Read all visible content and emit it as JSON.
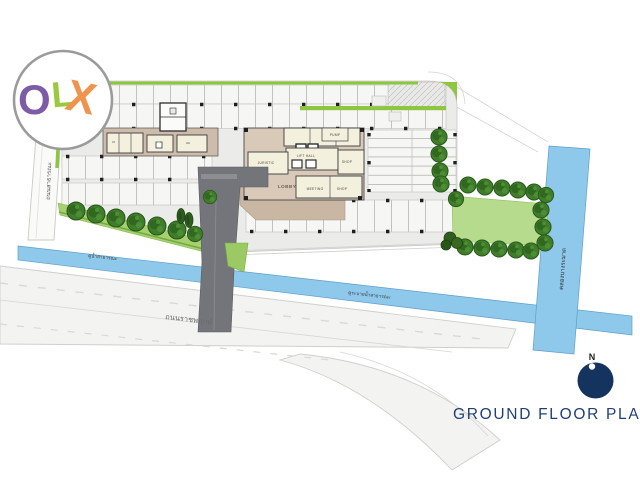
{
  "logo": {
    "letters": [
      {
        "char": "O",
        "color": "#7d5ba6"
      },
      {
        "char": "L",
        "color": "#9bc93d"
      },
      {
        "char": "X",
        "color": "#f0944d"
      }
    ]
  },
  "title": {
    "text": "GROUND FLOOR PLAN"
  },
  "north": {
    "label": "N"
  },
  "building": {
    "rooms": {
      "pump": "PUMP",
      "lift_hall": "LIFT HALL",
      "juristic": "JURISTIC",
      "shop_upper": "SHOP",
      "lobby": "LOBBY",
      "meeting": "MEETING",
      "shop_lower": "SHOP"
    }
  },
  "roads": {
    "main": "ถนนราชพฤกษ์",
    "side": "ถนนสาธารณะ"
  },
  "canals": {
    "left": "คูน้ำสาธารณะ",
    "right": "คูระบายน้ำสาธารณะ",
    "vertical": "คลองบางระมาด"
  },
  "colors": {
    "navy": "#14335f",
    "title_navy": "#1e4076",
    "canal": "#8ec8ea",
    "lawn": "#b7db8c",
    "green_accent": "#8dc63f",
    "paving": "#ebebe9",
    "tan": "#c9b7a3",
    "building_tan": "#d8c9b9",
    "room_cream": "#f3f0de",
    "driveway": "#74757a",
    "tree_green": "#3f7d2b"
  }
}
